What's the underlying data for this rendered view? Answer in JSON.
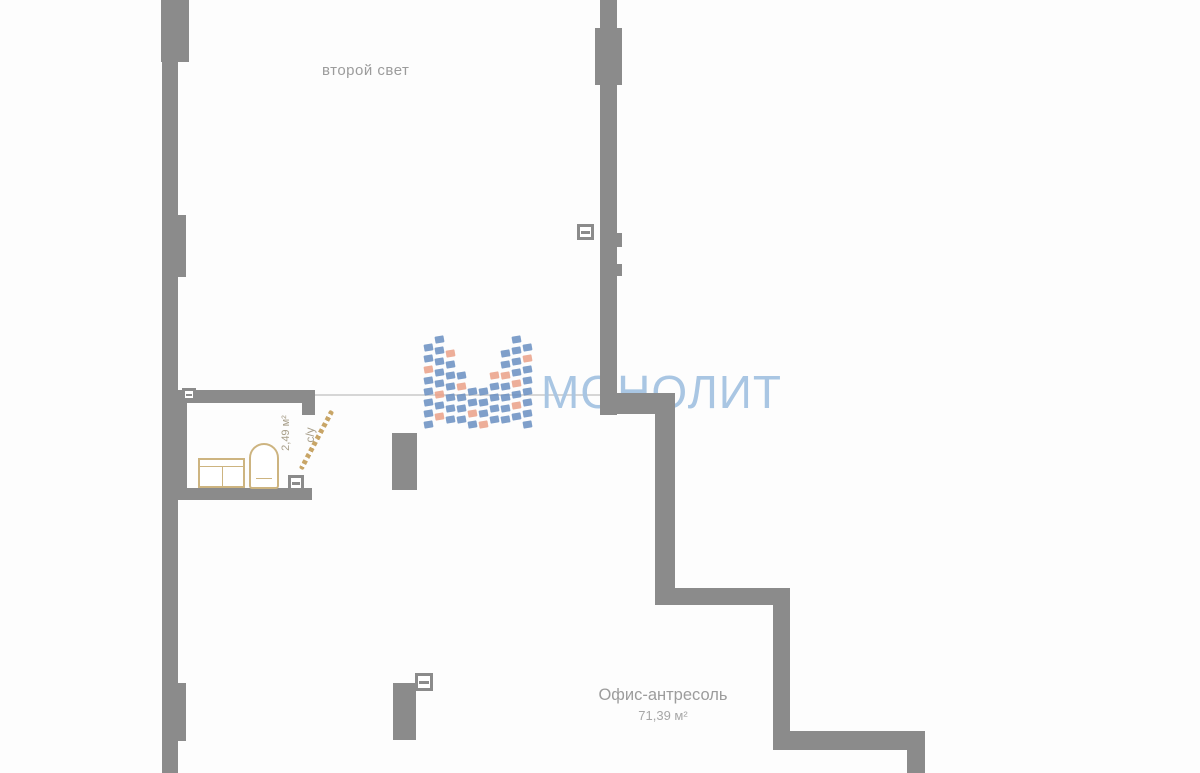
{
  "labels": {
    "second_light": "второй свет",
    "office_name": "Офис-антресоль",
    "office_area": "71,39 м²",
    "bathroom_name": "с/у",
    "bathroom_area": "2,49 м²"
  },
  "watermark": {
    "brand_name": "МОНОЛИТ"
  },
  "colors": {
    "wall_gray": "#8b8b8b",
    "watermark_blue": "#a9c6e3",
    "tile_blue": "#6d92c3",
    "tile_salmon": "#eba38b",
    "fixture_tan": "#cdb480",
    "door_tan": "#c8a566",
    "label_gray": "#9c9c9c",
    "bathroom_label_tan": "#a89f8a"
  }
}
